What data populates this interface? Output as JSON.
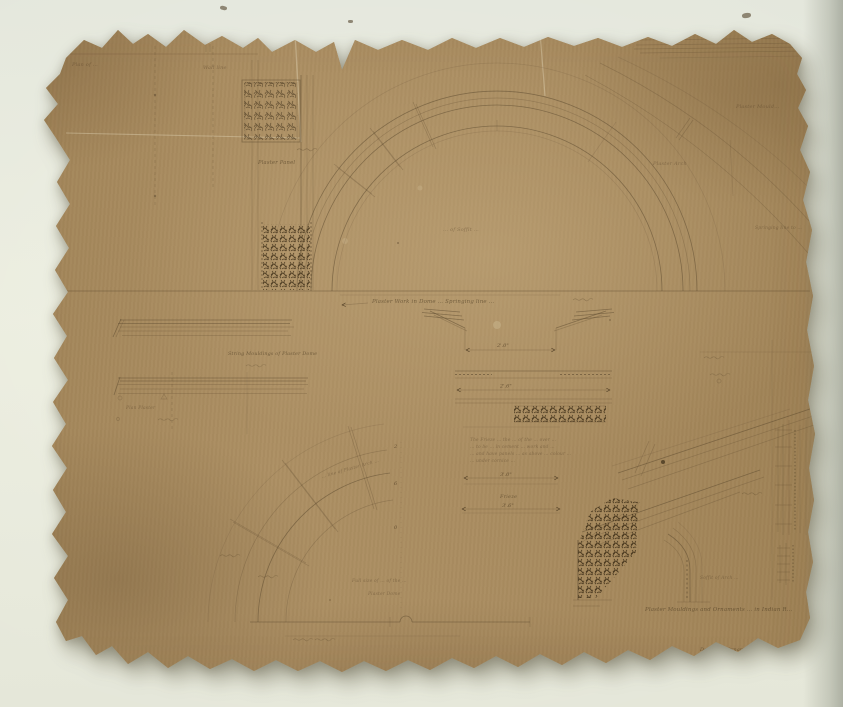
{
  "scene": {
    "kind": "photograph of a torn hand-drawn architectural detail sheet",
    "paper_color": "#a7895c",
    "ink_color": "#463420",
    "backdrop_color": "#e8eadf"
  },
  "drawing": {
    "bottom_caption": "Plaster Mouldings and Ornaments … in Indian R…",
    "credit_line_1": "Details of Ornamental parts of Ch…",
    "credit_line_2": "and Indian patterns … Monument …",
    "credit_line_3": "Calcutta",
    "labels": {
      "plan_of_jamb": "Plan of …",
      "wall_line": "Wall line",
      "plaster_panel": "Plaster Panel",
      "plaster_mould": "Plaster Mould…",
      "plaster_arch": "Plaster Arch",
      "springing_note": "Springing line to …",
      "springing_caption": "Plaster Work in Dome … Springing line …",
      "soffit_plan": "… of Soffit …",
      "string_moulding": "String Mouldings of Plaster Dome",
      "plan_plaster": "Plan Plaster",
      "arc_caption": "… line of Plaster Arch …",
      "arc_note_1": "Full size of … of the …",
      "arc_note_2": "Plaster Dome",
      "soffit_label": "Soffit of Arch …",
      "frieze_label": "Frieze",
      "note_line_1": "The Frieze … the … of the … over …",
      "note_line_2": "… to be … in cement … work and …",
      "note_line_3": "… and have panels … as above … colour …",
      "note_line_4": "… under cornice …"
    },
    "dimensions": {
      "d_2_0": "2'.0\"",
      "d_2_6": "2'.6\"",
      "d_3_0": "3'.0\"",
      "d_3_6": "3'.6\"",
      "markers": [
        "2",
        "6",
        "0"
      ]
    }
  }
}
